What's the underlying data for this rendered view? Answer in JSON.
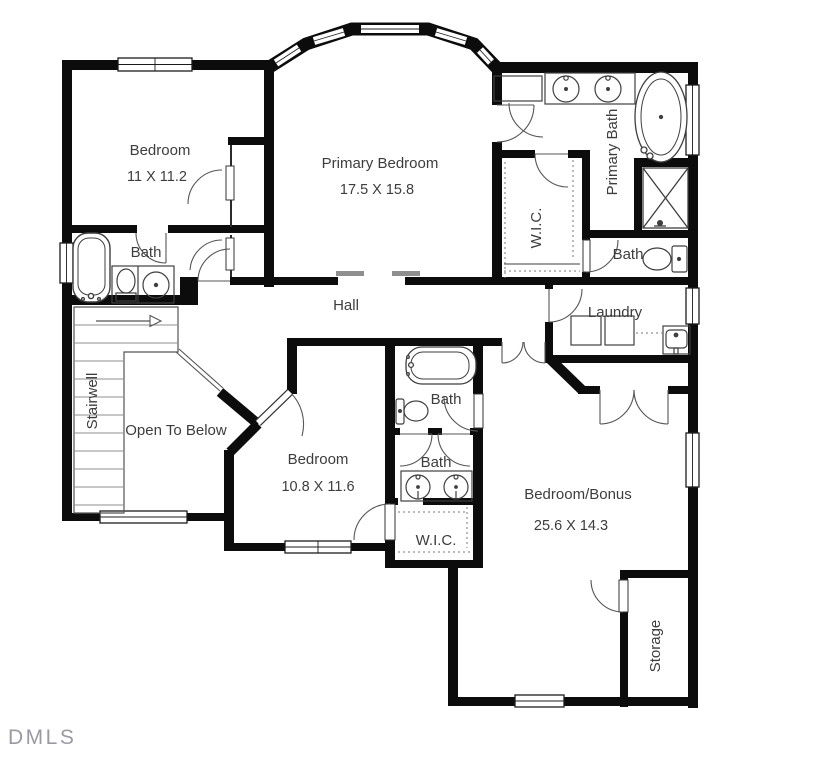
{
  "watermark": "DMLS",
  "colors": {
    "wall": "#0c0c0c",
    "fixture_line": "#3f3f3f",
    "door_arc": "#555555",
    "label_text": "#3d3d3d",
    "opening_tick": "#8f8f8f",
    "watermark": "#9a9aa2"
  },
  "rooms": {
    "bedroom1": {
      "name": "Bedroom",
      "dims": "11 X 11.2"
    },
    "primary": {
      "name": "Primary Bedroom",
      "dims": "17.5 X 15.8"
    },
    "primary_bath": {
      "name": "Primary Bath"
    },
    "wic_primary": {
      "name": "W.I.C."
    },
    "bath_top_left": {
      "name": "Bath"
    },
    "bath_toilet": {
      "name": "Bath"
    },
    "hall": {
      "name": "Hall"
    },
    "laundry": {
      "name": "Laundry"
    },
    "stairwell": {
      "name": "Stairwell"
    },
    "open_below": {
      "name": "Open To Below"
    },
    "bedroom2": {
      "name": "Bedroom",
      "dims": "10.8 X 11.6"
    },
    "bath_mid_tub": {
      "name": "Bath"
    },
    "bath_mid_sink": {
      "name": "Bath"
    },
    "wic_mid": {
      "name": "W.I.C."
    },
    "bonus": {
      "name": "Bedroom/Bonus",
      "dims": "25.6 X 14.3"
    },
    "storage": {
      "name": "Storage"
    }
  }
}
